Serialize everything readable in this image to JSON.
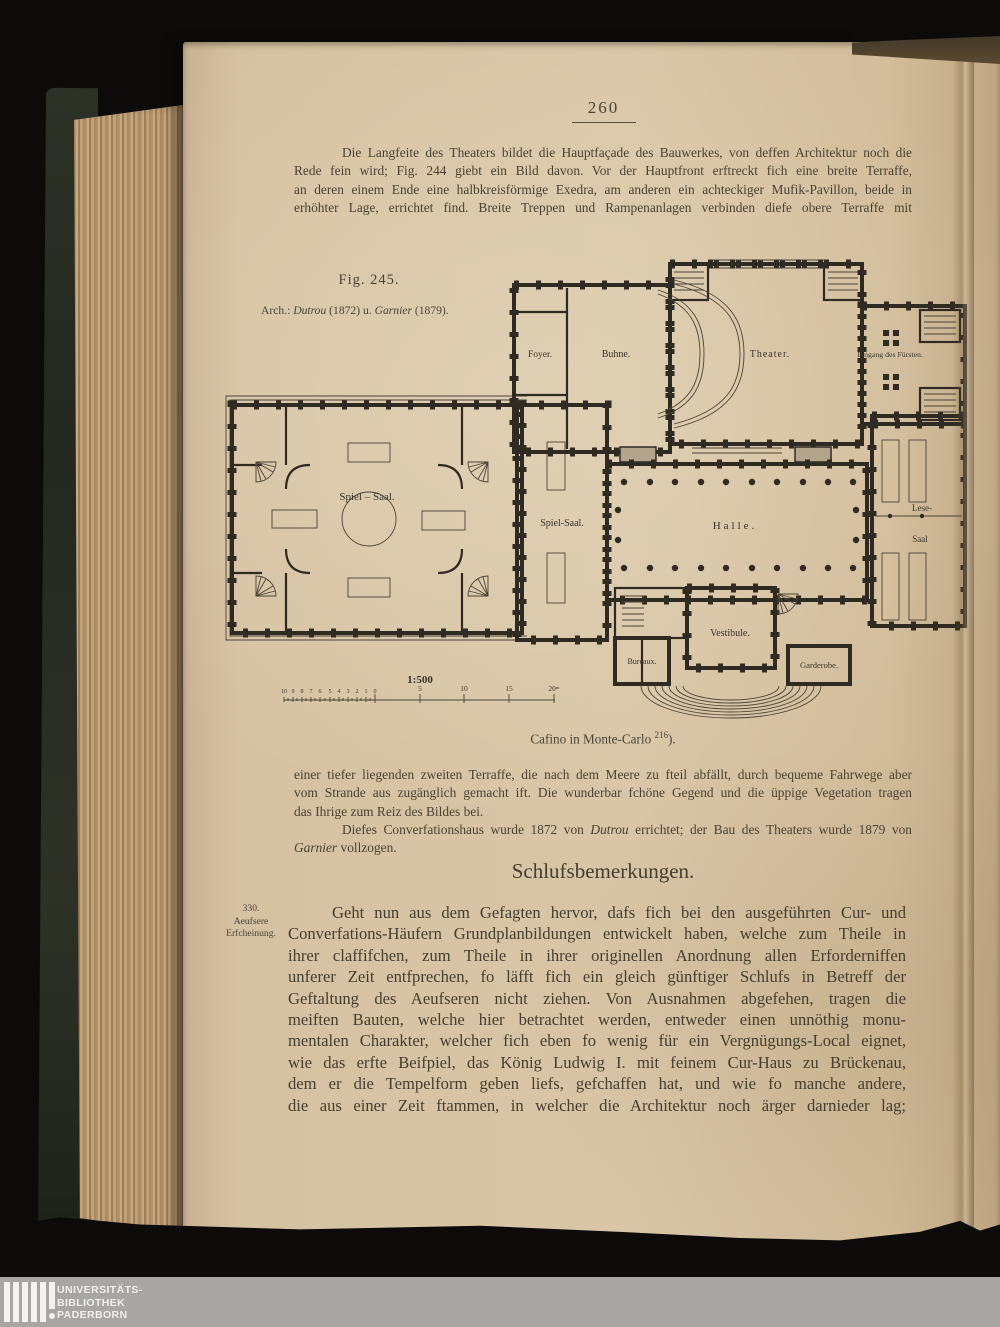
{
  "document": {
    "page_number": "260",
    "para1": [
      "Die Langfeite des Theaters bildet die Hauptfaçade des Bauwerkes, von deffen Architektur noch die",
      "Rede fein wird; Fig. 244 giebt ein Bild davon.  Vor der Hauptfront erftreckt fich eine breite Terraffe,",
      "an deren einem Ende eine halbkreisförmige Exedra, am anderen ein achteckiger Mufik-Pavillon, beide in",
      "erhöhter Lage, errichtet find.  Breite Treppen und Rampenanlagen verbinden diefe obere Terraffe mit"
    ],
    "figure": {
      "label": "Fig. 245.",
      "arch_prefix": "Arch.: ",
      "arch_name1": "Dutrou",
      "arch_mid": " (1872) u. ",
      "arch_name2": "Garnier",
      "arch_end": " (1879).",
      "caption": "Cafino in Monte-Carlo ",
      "caption_sup": "216",
      "caption_close": ")."
    },
    "para2": {
      "l1": "einer tiefer liegenden zweiten Terraffe, die nach dem Meere zu fteil abfällt, durch bequeme Fahrwege aber",
      "l2": "vom Strande aus zugänglich gemacht ift.  Die wunderbar fchöne Gegend und die üppige Vegetation tragen",
      "l3": "das Ihrige zum Reiz des Bildes bei.",
      "l4a": "Diefes Converfationshaus wurde 1872 von ",
      "l4b": "Dutrou",
      "l4c": " errichtet; der Bau des Theaters wurde 1879 von",
      "l5a": "Garnier",
      "l5b": " vollzogen."
    },
    "heading": "Schlufsbemerkungen.",
    "margin_note": [
      "330.",
      "Aeufsere",
      "Erfcheinung."
    ],
    "para3": [
      "Geht nun aus dem Gefagten hervor, dafs fich bei den ausgeführten Cur- und",
      "Converfations-Häufern Grundplanbildungen entwickelt haben, welche zum Theile in",
      "ihrer claffifchen, zum Theile in ihrer originellen Anordnung allen Erforderniffen",
      "unferer Zeit entfprechen, fo läfft fich ein gleich günftiger Schlufs in Betreff der",
      "Geftaltung des Aeufseren nicht ziehen.  Von Ausnahmen abgefehen, tragen die",
      "meiften Bauten, welche hier betrachtet werden, entweder einen unnöthig monu-",
      "mentalen Charakter, welcher fich eben fo wenig für ein Vergnügungs-Local eignet,",
      "wie das erfte Beifpiel, das König Ludwig I. mit feinem Cur-Haus zu Brückenau,",
      "dem er die Tempelform geben liefs, gefchaffen hat, und wie fo manche andere,",
      "die aus einer Zeit ftammen, in welcher die Architektur noch ärger darnieder lag;"
    ]
  },
  "plan": {
    "rooms": {
      "foyer": "Foyer.",
      "buhne": "Buhne.",
      "theater": "Theater.",
      "eingang": "Eingang des Fürsten.",
      "spiel_gross": "Spiel – Saal.",
      "spiel_klein": "Spiel-Saal.",
      "halle": "Halle.",
      "lese1": "Lese-",
      "lese2": "Saal",
      "vestibule": "Vestibule.",
      "bureaux": "Bureaux.",
      "garderobe": "Garderobe."
    },
    "scale": {
      "ratio": "1:500",
      "left": [
        "10",
        "9",
        "8",
        "7",
        "6",
        "5",
        "4",
        "3",
        "2",
        "1",
        "0"
      ],
      "major": [
        "5",
        "10",
        "15",
        "20ᵐ"
      ]
    }
  },
  "footer": {
    "line1": "UNIVERSITÄTS-",
    "line2": "BIBLIOTHEK",
    "line3": "PADERBORN"
  }
}
